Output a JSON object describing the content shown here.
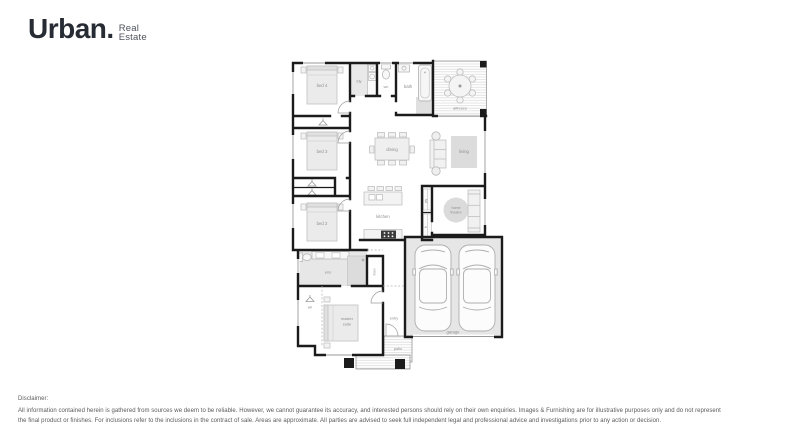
{
  "brand": {
    "name": "Urban.",
    "tagline_line1": "Real",
    "tagline_line2": "Estate"
  },
  "floorplan": {
    "labels": {
      "bed4": "bed 4",
      "ldy": "ldy",
      "wc": "wc",
      "bath": "bath",
      "alfresco": "alfresco",
      "bed3": "bed 3",
      "dining": "dining",
      "living": "living",
      "bed2": "bed 2",
      "kitchen": "kitchen",
      "pty": "pty",
      "fr": "fr",
      "home_theatre_line1": "home",
      "home_theatre_line2": "theatre",
      "ens": "ens",
      "linen": "linen",
      "wir": "wir",
      "master_line1": "master",
      "master_line2": "suite",
      "entry": "entry",
      "patio": "patio",
      "garage": "garage"
    }
  },
  "disclaimer": {
    "title": "Disclaimer:",
    "line1": "All information contained herein is gathered from sources we deem to be reliable. However, we cannot guarantee its accuracy, and interested persons should rely on their own enquiries. Images & Furnishing are for illustrative purposes only and do not represent",
    "line2": "the final product or finishes. For inclusions refer to the inclusions in the contract of sale. Areas are approximate. All parties are advised to seek full independent legal and professional advice and investigations prior to any action or decision."
  },
  "colors": {
    "wall": "#1b1b1b",
    "floor_tint": "#e7e7e7",
    "furniture": "#c0c0c0",
    "label": "#8f8f8f",
    "logo": "#272c34"
  }
}
